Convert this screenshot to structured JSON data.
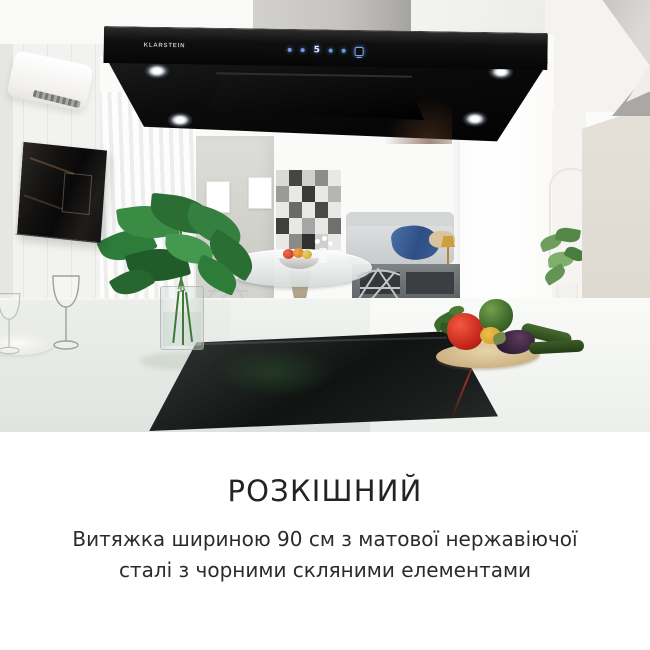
{
  "photo": {
    "alt": "Modern white kitchen with black wall-mounted range hood over an island with black glass cooktop, vegetables on a cutting board, monstera plant and living room in background",
    "hood": {
      "brand_label": "KLARSTEIN",
      "display_value": "5",
      "control_icons": [
        "power-dot",
        "minus-dot",
        "fan-speed-display",
        "plus-dot",
        "timer-dot",
        "light-icon"
      ],
      "body_color": "#0a0a0a",
      "control_glow_color": "#6f9ddd"
    },
    "scene_colors": {
      "countertop": "#e9ece8",
      "cooktop_glass": "#16191 8",
      "beige_wall": "#ded9d0",
      "plant_green": "#2e7c39",
      "throw_blue": "#3d5f96"
    }
  },
  "caption": {
    "heading": "РОЗКІШНИЙ",
    "lines": [
      "Витяжка шириною 90 см з матової нержавіючої",
      "сталі з чорними скляними елементами"
    ],
    "text_color": "#232323"
  }
}
